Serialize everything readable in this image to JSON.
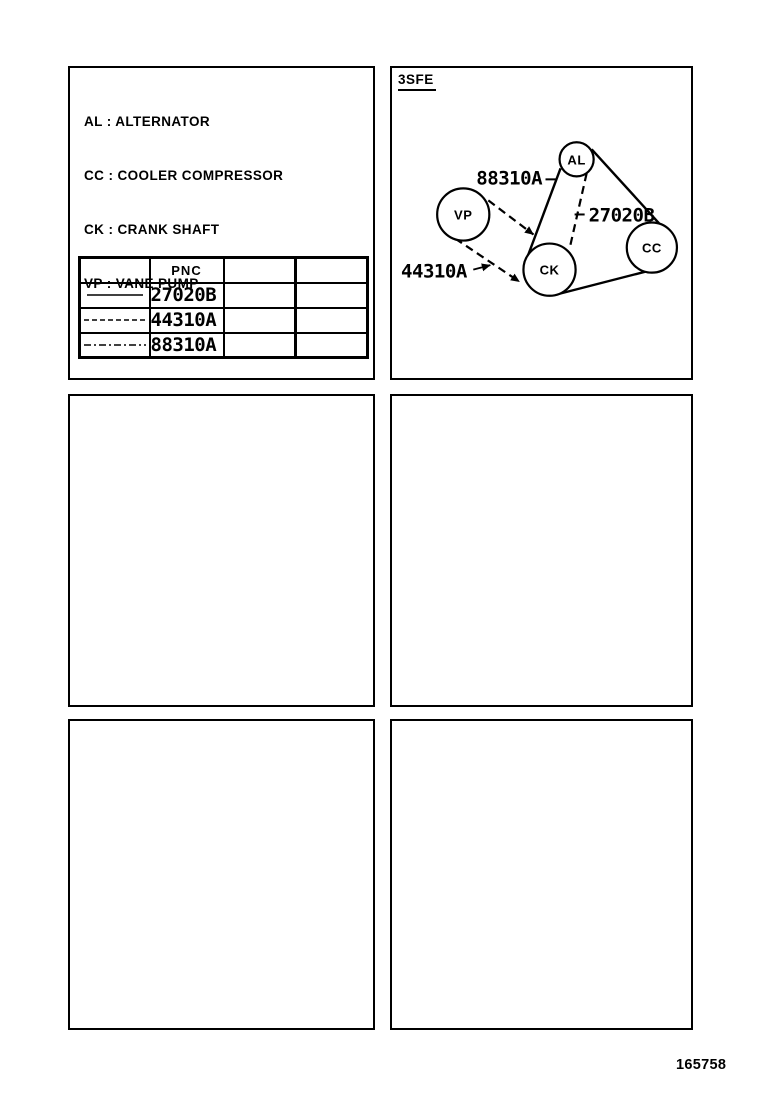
{
  "page": {
    "number": "165758",
    "ink_color": "#000000",
    "background_color": "#ffffff"
  },
  "legend": {
    "lines": [
      "AL : ALTERNATOR",
      "CC : COOLER COMPRESSOR",
      "CK : CRANK SHAFT",
      "VP : VANE PUMP"
    ]
  },
  "table": {
    "header_pnc": "PNC",
    "rows": [
      {
        "pnc": "27020B",
        "line_style": "solid",
        "dasharray": "none"
      },
      {
        "pnc": "44310A",
        "line_style": "dashed",
        "dasharray": "5 3"
      },
      {
        "pnc": "88310A",
        "line_style": "dash-dot",
        "dasharray": "7 3 2 3"
      }
    ]
  },
  "diagram": {
    "engine_code": "3SFE",
    "pulleys": [
      {
        "id": "AL",
        "label": "AL"
      },
      {
        "id": "VP",
        "label": "VP"
      },
      {
        "id": "CK",
        "label": "CK"
      },
      {
        "id": "CC",
        "label": "CC"
      }
    ],
    "callouts": [
      {
        "text": "88310A",
        "leader": "dash"
      },
      {
        "text": "27020B",
        "leader": "dash"
      },
      {
        "text": "44310A",
        "leader": "arrow"
      }
    ],
    "belts": [
      {
        "pnc": "27020B",
        "style": "solid",
        "connects": [
          "CK",
          "AL",
          "CC"
        ]
      },
      {
        "pnc": "44310A",
        "style": "dashed",
        "connects": [
          "VP",
          "CK"
        ]
      },
      {
        "pnc": "88310A",
        "style": "dashed",
        "connects": [
          "AL",
          "CK"
        ]
      }
    ],
    "belt_dasharray": "8 5"
  }
}
